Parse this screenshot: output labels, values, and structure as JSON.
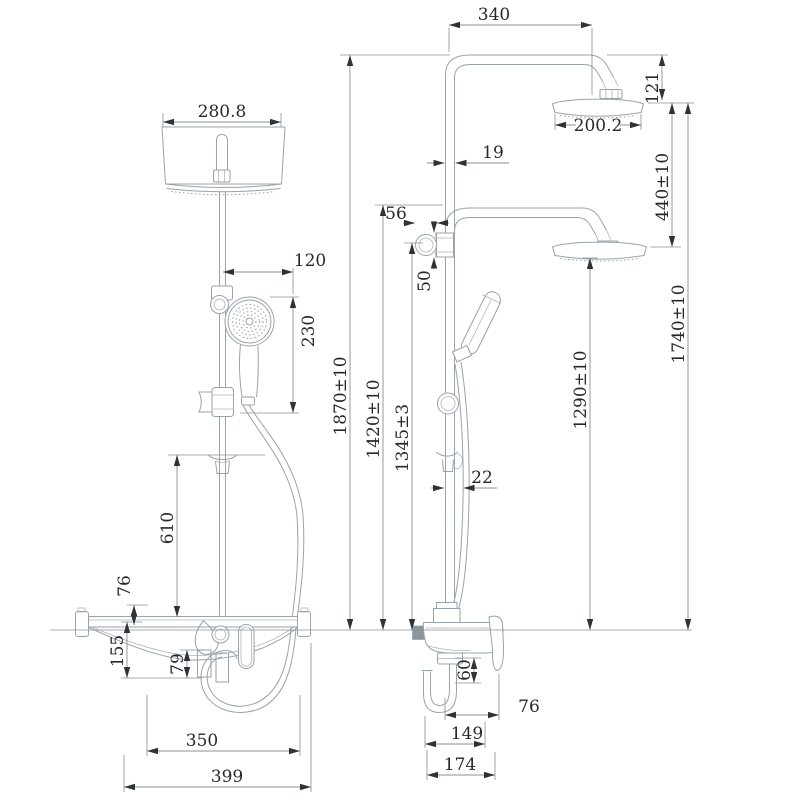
{
  "drawing": {
    "type": "shower-system-dimensional-drawing",
    "views": {
      "left": "front-view",
      "right": "side-view"
    }
  },
  "colors": {
    "geometry": "#9aa2ab",
    "dimension": "#8a9097",
    "arrow": "#2f3237",
    "text": "#26292c",
    "background": "#ffffff",
    "inlet_fill": "#8d949b"
  },
  "dims": {
    "d280_8": {
      "label": "280.8"
    },
    "d120": {
      "label": "120"
    },
    "d230": {
      "label": "230"
    },
    "d1870": {
      "label": "1870±10"
    },
    "d610": {
      "label": "610"
    },
    "d76_left": {
      "label": "76"
    },
    "d155": {
      "label": "155"
    },
    "d79": {
      "label": "79"
    },
    "d350": {
      "label": "350"
    },
    "d399": {
      "label": "399"
    },
    "d340": {
      "label": "340"
    },
    "d121": {
      "label": "121"
    },
    "d200_2": {
      "label": "200.2"
    },
    "d19": {
      "label": "19"
    },
    "d56": {
      "label": "56"
    },
    "d50": {
      "label": "50"
    },
    "d1420": {
      "label": "1420±10"
    },
    "d1345": {
      "label": "1345±3"
    },
    "d1290": {
      "label": "1290±10"
    },
    "d440": {
      "label": "440±10"
    },
    "d1740": {
      "label": "1740±10"
    },
    "d22": {
      "label": "22"
    },
    "d60": {
      "label": "60"
    },
    "d76_right": {
      "label": "76"
    },
    "d149": {
      "label": "149"
    },
    "d174": {
      "label": "174"
    }
  }
}
